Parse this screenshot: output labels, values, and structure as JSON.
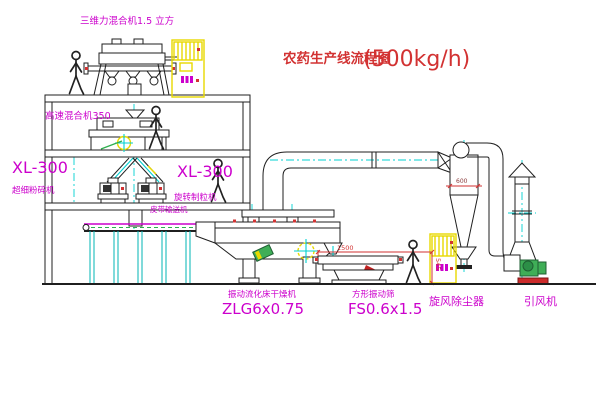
{
  "title": {
    "name": "农药生产线流程图",
    "capacity": "(500kg/h)"
  },
  "machines": {
    "top_mixer": "三维力混合机1.5 立方",
    "high_speed_mixer": "高速混合机350",
    "pulverizer": {
      "model": "XL-300",
      "name": "超细粉碎机"
    },
    "granulator": {
      "model": "XL-300",
      "name": "旋转制粒机"
    },
    "belt_conveyor": "皮带输送机",
    "dryer": {
      "name": "振动流化床干燥机",
      "model": "ZLG6x0.75"
    },
    "sieve": {
      "name": "方形振动筛",
      "model": "FS0.6x1.5"
    },
    "cyclone": "旋风除尘器",
    "fan": "引风机"
  },
  "dimensions": {
    "sieve_length": "1500",
    "sieve_height": "545",
    "cyclone_inlet": "600"
  },
  "colors": {
    "label_magenta": "#cc00cc",
    "title_red": "#d23232",
    "centerline_cyan": "#00d0d0",
    "cabinet_yellow": "#e8d900",
    "machine_green": "#3fae57",
    "line_black": "#1f1f1f"
  }
}
